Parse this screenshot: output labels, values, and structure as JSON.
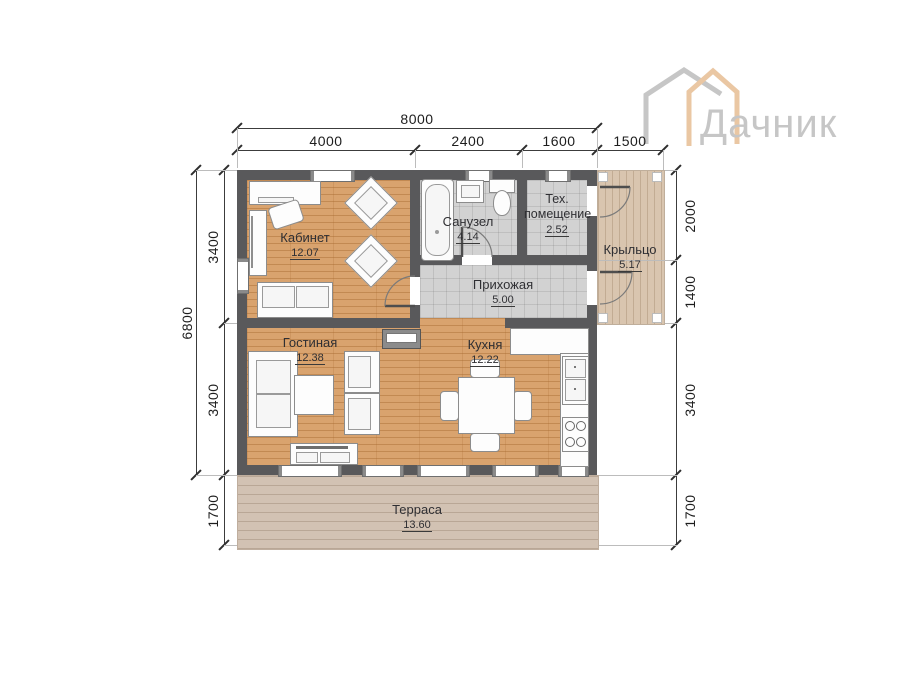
{
  "logo": {
    "brand": "Дачник"
  },
  "dimensions": {
    "top_total": "8000",
    "top_segments": [
      "4000",
      "2400",
      "1600",
      "1500"
    ],
    "left_total": "6800",
    "left_segments": [
      "3400",
      "3400",
      "1700"
    ],
    "right_segments": [
      "2000",
      "1400",
      "3400",
      "1700"
    ]
  },
  "rooms": {
    "office": {
      "name": "Кабинет",
      "area": "12.07"
    },
    "bathroom": {
      "name": "Санузел",
      "area": "4.14"
    },
    "tech": {
      "name": "Тех. помещение",
      "area": "2.52"
    },
    "porch": {
      "name": "Крыльцо",
      "area": "5.17"
    },
    "hallway": {
      "name": "Прихожая",
      "area": "5.00"
    },
    "living": {
      "name": "Гостиная",
      "area": "12.38"
    },
    "kitchen": {
      "name": "Кухня",
      "area": "12.22"
    },
    "terrace": {
      "name": "Терраса",
      "area": "13.60"
    }
  },
  "colors": {
    "wall": "#59595b",
    "wood_floor": "#d9a36e",
    "tile_floor": "#d2d2d2",
    "porch_deck": "#d9c5af",
    "terrace_deck": "#d2c2b3",
    "logo_peach": "#eac7a3",
    "logo_gray": "#c6c6c6"
  }
}
